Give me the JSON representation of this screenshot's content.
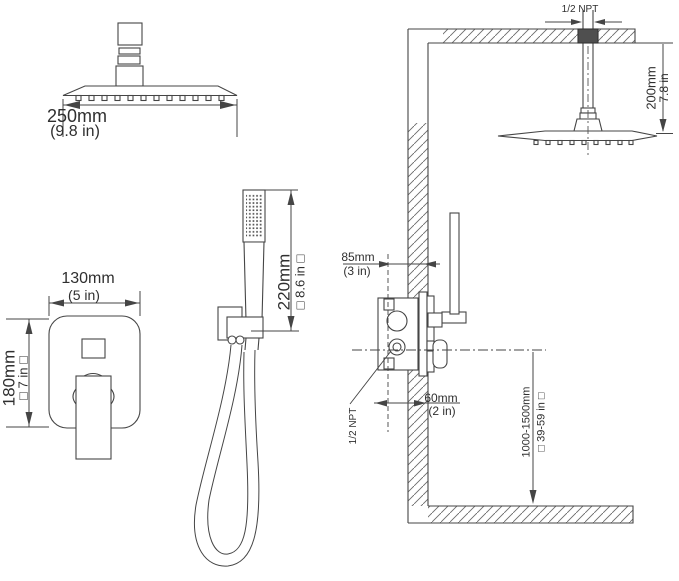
{
  "colors": {
    "line": "#454545",
    "text": "#2f2f2f",
    "fitting_fill": "#4f4f4f"
  },
  "views": {
    "shower_head_front": {
      "width_mm": "250mm",
      "width_in": "(9.8 in)"
    },
    "mixer_valve_front": {
      "width_mm": "130mm",
      "width_in": "(5 in)",
      "height_mm": "180mm",
      "height_in": "□ 7 in □"
    },
    "hand_shower": {
      "height_mm": "220mm",
      "height_in": "□ 8.6 in □"
    },
    "installation": {
      "ceiling_thread": "1/2 NPT",
      "arm_length_mm": "200mm",
      "arm_length_in": "7.8 in",
      "valve_depth_mm": "85mm",
      "valve_depth_in": "(3 in)",
      "wall_offset_mm": "60mm",
      "wall_offset_in": "(2 in)",
      "valve_thread": "1/2 NPT",
      "mount_height_mm": "1000-1500mm",
      "mount_height_in": "□ 39-59 in □"
    }
  }
}
